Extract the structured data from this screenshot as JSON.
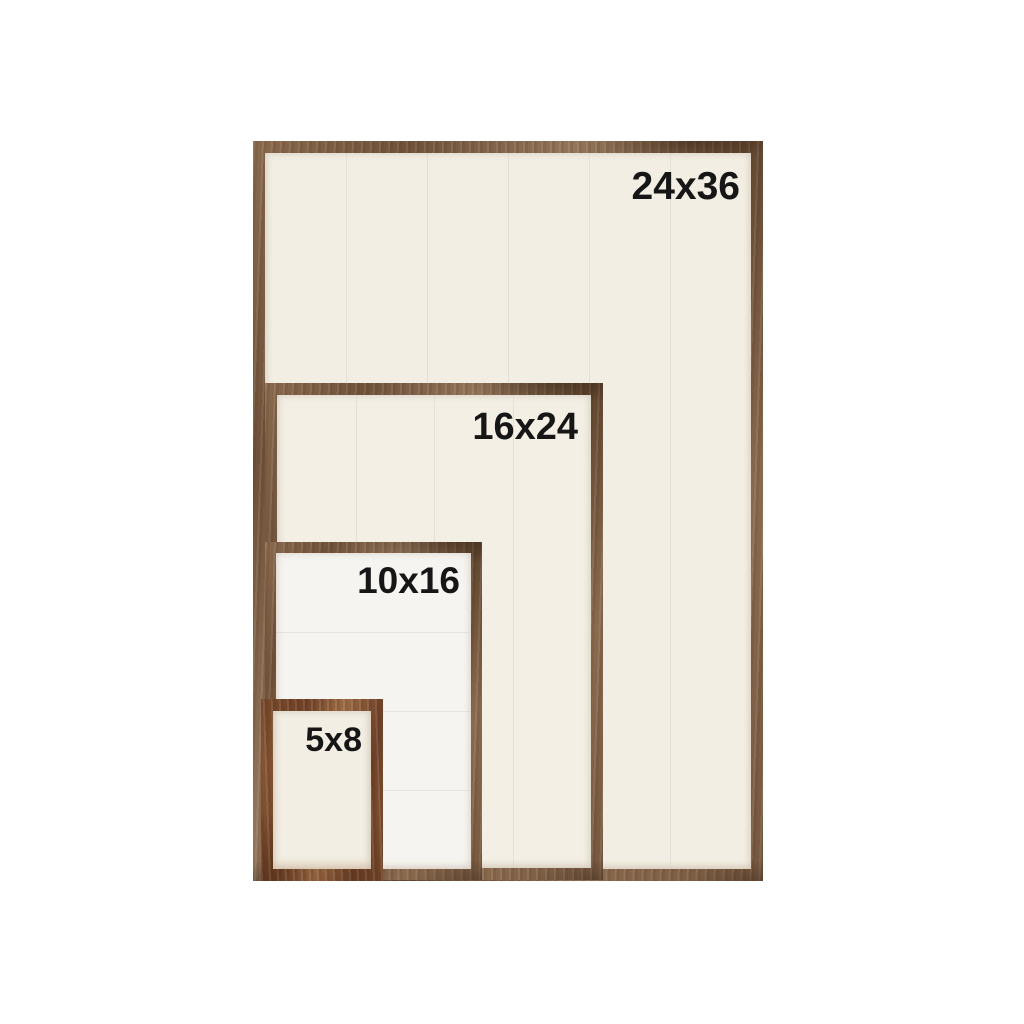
{
  "page": {
    "background_color": "#ffffff",
    "label_color": "#161616"
  },
  "frames": [
    {
      "name": "frame-24x36",
      "label": "24x36",
      "plank_direction": "vertical",
      "plank_count": 6,
      "wood_color": "#7b5c41",
      "panel_color": "#f3eee3"
    },
    {
      "name": "frame-16x24",
      "label": "16x24",
      "plank_direction": "vertical",
      "plank_count": 4,
      "wood_color": "#7b5c41",
      "panel_color": "#f3efe5"
    },
    {
      "name": "frame-10x16",
      "label": "10x16",
      "plank_direction": "horizontal",
      "plank_count": 4,
      "wood_color": "#7a5a40",
      "panel_color": "#f6f4f0"
    },
    {
      "name": "frame-5x8",
      "label": "5x8",
      "plank_direction": "none",
      "plank_count": 1,
      "wood_color": "#84502f",
      "panel_color": "#f2eee4"
    }
  ]
}
